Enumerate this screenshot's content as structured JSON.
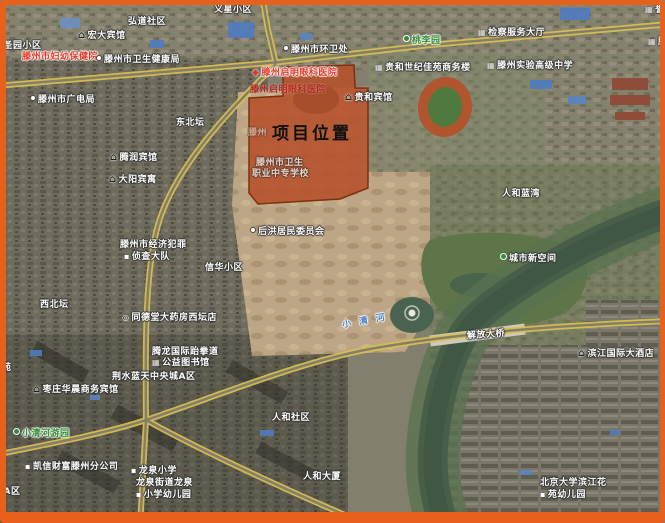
{
  "annotation": {
    "project_label": "项目位置"
  },
  "colors": {
    "frame": "#e7601c",
    "project_polygon_fill": "#b5512b",
    "project_polygon_stroke": "#7e2f10",
    "road_yellow": "#d9bf4e",
    "water": "#475f49",
    "label_red": "#e33a2c",
    "label_green": "#2f8a2f",
    "river_label_blue": "#4d7fc9"
  },
  "map": {
    "type": "satellite",
    "labels": [
      {
        "name": "label-yixing-xiaoqu",
        "text": "义星小区",
        "x": 214,
        "y": 5
      },
      {
        "name": "label-hongdao-shequ",
        "text": "弘道社区",
        "x": 128,
        "y": 17
      },
      {
        "name": "label-hongda-hotel",
        "text": "宏大宾馆",
        "x": 78,
        "y": 31,
        "icon": "hotel-icon"
      },
      {
        "name": "label-keshengyuan-xiaoqu",
        "text": "科圣园小区",
        "x": -6,
        "y": 41
      },
      {
        "name": "label-fuyou-baojianyuan",
        "text": "滕州市妇幼保健院",
        "x": 22,
        "y": 52,
        "color": "red"
      },
      {
        "name": "label-weisheng-jiankangju",
        "text": "滕州市卫生健康局",
        "x": 96,
        "y": 55,
        "icon": "dot-icon"
      },
      {
        "name": "label-huanweichu",
        "text": "滕州市环卫处",
        "x": 283,
        "y": 45,
        "icon": "dot-icon"
      },
      {
        "name": "label-jiancha-dating",
        "text": "检察服务大厅",
        "x": 478,
        "y": 28,
        "icon": "building-icon"
      },
      {
        "name": "label-taoliyuan",
        "text": "桃李园",
        "x": 403,
        "y": 35,
        "color": "green",
        "icon": "park-icon"
      },
      {
        "name": "label-clipped-topright-1",
        "text": "誉王中",
        "x": 645,
        "y": 5,
        "icon": "building-icon"
      },
      {
        "name": "label-clipped-topright-2",
        "text": "滕州",
        "x": 648,
        "y": 37,
        "icon": "building-icon"
      },
      {
        "name": "label-guihe-shangwulou",
        "text": "贵和世纪佳苑商务楼",
        "x": 375,
        "y": 63,
        "icon": "building-icon"
      },
      {
        "name": "label-shiyan-gaoji-zhongxue",
        "text": "滕州实验高级中学",
        "x": 487,
        "y": 61,
        "icon": "building-icon"
      },
      {
        "name": "label-qiming-yanke-1",
        "text": "滕州启明眼科医院",
        "x": 252,
        "y": 68,
        "color": "red",
        "icon": "marker-icon"
      },
      {
        "name": "label-qiming-yanke-2",
        "text": "滕州启明眼科医院",
        "x": 250,
        "y": 85,
        "color": "red-dark"
      },
      {
        "name": "label-guihe-hotel",
        "text": "贵和宾馆",
        "x": 345,
        "y": 93,
        "icon": "hotel-icon"
      },
      {
        "name": "label-guangdianju",
        "text": "滕州市广电局",
        "x": 30,
        "y": 95,
        "icon": "dot-icon"
      },
      {
        "name": "label-dongbeitan",
        "text": "东北坛",
        "x": 176,
        "y": 118
      },
      {
        "name": "project-location-label",
        "text": "项目位置",
        "x": 272,
        "y": 125,
        "color": "black",
        "style": "project"
      },
      {
        "name": "label-faint-tengzhou",
        "text": "滕州",
        "x": 248,
        "y": 128,
        "opacity": 0.45
      },
      {
        "name": "label-tengrun-hotel",
        "text": "腾润宾馆",
        "x": 110,
        "y": 153,
        "icon": "hotel-icon"
      },
      {
        "name": "label-dayang-hotel",
        "text": "大阳宾寓",
        "x": 109,
        "y": 175,
        "icon": "hotel-icon"
      },
      {
        "name": "label-weisheng-xuexiao-1",
        "text": "滕州市卫生",
        "x": 256,
        "y": 158,
        "opacity": 0.72
      },
      {
        "name": "label-weisheng-xuexiao-2",
        "text": "职业中专学校",
        "x": 252,
        "y": 169,
        "opacity": 0.72
      },
      {
        "name": "label-renhe-lanwan",
        "text": "人和蓝湾",
        "x": 502,
        "y": 189
      },
      {
        "name": "label-houhong-weiyuanhui",
        "text": "后洪居民委员会",
        "x": 250,
        "y": 227,
        "icon": "dot-icon"
      },
      {
        "name": "label-jingzhen-dadui-1",
        "text": "滕州市经济犯罪",
        "x": 120,
        "y": 240
      },
      {
        "name": "label-jingzhen-dadui-2",
        "text": "侦查大队",
        "x": 124,
        "y": 252,
        "icon": "school-icon"
      },
      {
        "name": "label-xinhua-xiaoqu",
        "text": "信华小区",
        "x": 205,
        "y": 263
      },
      {
        "name": "label-chengshi-xinkongjian",
        "text": "城市新空间",
        "x": 500,
        "y": 253,
        "icon": "park-icon"
      },
      {
        "name": "label-xibeitan",
        "text": "西北坛",
        "x": 40,
        "y": 300
      },
      {
        "name": "label-tongdetang-yaofang",
        "text": "同德堂大药房西坛店",
        "x": 122,
        "y": 313,
        "icon": "circle-icon"
      },
      {
        "name": "river-name-label",
        "text": "小清河",
        "x": 342,
        "y": 316,
        "color": "blue",
        "style": "river",
        "rotate": -10
      },
      {
        "name": "label-jiefang-daqiao",
        "text": "解放大桥",
        "x": 467,
        "y": 330,
        "rotate": -4
      },
      {
        "name": "label-binjiang-hotel",
        "text": "滨江国际大酒店",
        "x": 578,
        "y": 349,
        "icon": "hotel-icon"
      },
      {
        "name": "label-tenglong-1",
        "text": "腾龙国际跆拳道",
        "x": 152,
        "y": 347
      },
      {
        "name": "label-tenglong-2",
        "text": "公益图书馆",
        "x": 152,
        "y": 358,
        "icon": "building-icon"
      },
      {
        "name": "label-jingshui-lantian",
        "text": "荆水蓝天中央城A区",
        "x": 112,
        "y": 372
      },
      {
        "name": "label-zaozhuang-huachen-hotel",
        "text": "枣庄华晨商务宾馆",
        "x": 33,
        "y": 385,
        "icon": "hotel-icon"
      },
      {
        "name": "label-clipped-left-yuan",
        "text": "苑",
        "x": 2,
        "y": 363
      },
      {
        "name": "label-renhe-shequ",
        "text": "人和社区",
        "x": 272,
        "y": 413
      },
      {
        "name": "label-xiaoqinghe-youyuan",
        "text": "小清河游园",
        "x": 13,
        "y": 428,
        "color": "green",
        "icon": "park-icon"
      },
      {
        "name": "label-kaixin-caifu",
        "text": "凯信财富滕州分公司",
        "x": 25,
        "y": 462,
        "icon": "school-icon"
      },
      {
        "name": "label-longquan-xiaoxue",
        "text": "龙泉小学",
        "x": 131,
        "y": 466,
        "icon": "school-icon"
      },
      {
        "name": "label-longquan-youeryuan-1",
        "text": "龙泉街道龙泉",
        "x": 136,
        "y": 478
      },
      {
        "name": "label-longquan-youeryuan-2",
        "text": "小学幼儿园",
        "x": 136,
        "y": 490,
        "icon": "school-icon"
      },
      {
        "name": "label-renhe-dasha",
        "text": "人和大厦",
        "x": 303,
        "y": 472
      },
      {
        "name": "label-clipped-left-aqu",
        "text": "城A区",
        "x": -6,
        "y": 487
      },
      {
        "name": "label-beida-binjiang-1",
        "text": "北京大学滨江花",
        "x": 540,
        "y": 478
      },
      {
        "name": "label-beida-binjiang-2",
        "text": "苑幼儿园",
        "x": 540,
        "y": 490,
        "icon": "school-icon"
      }
    ]
  }
}
